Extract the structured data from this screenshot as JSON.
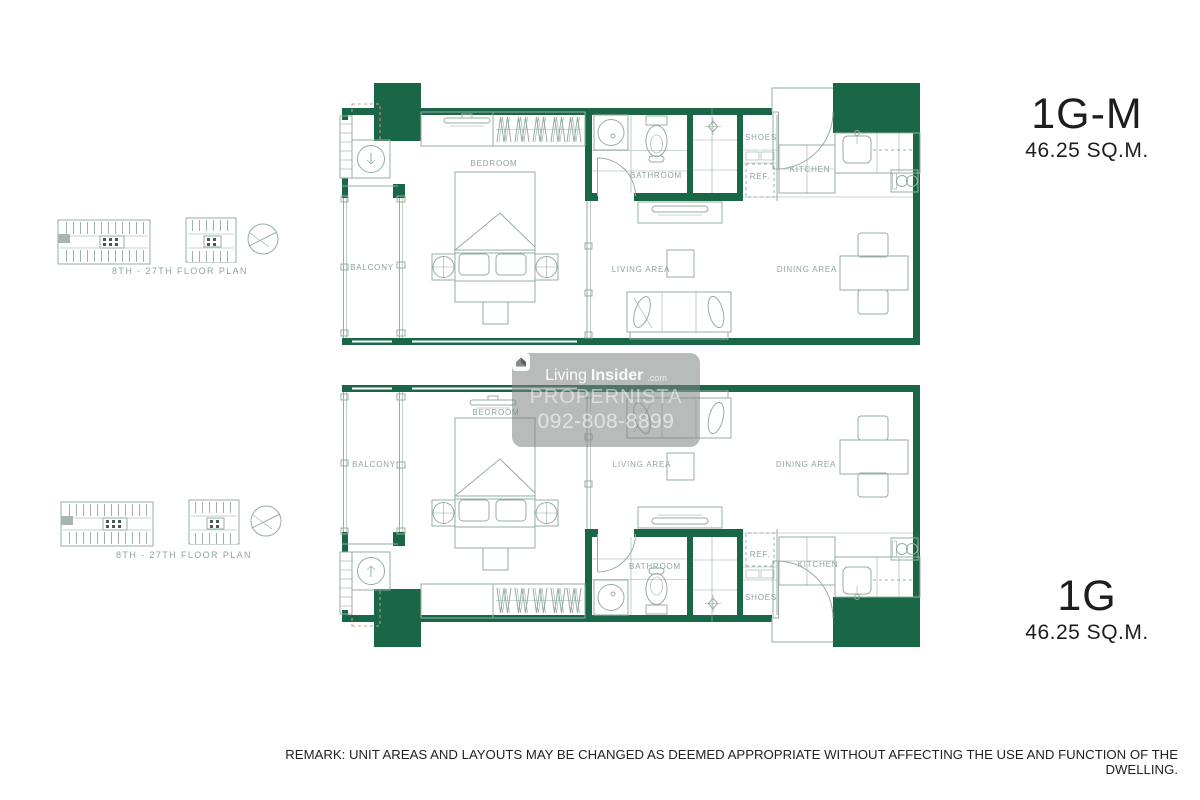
{
  "colors": {
    "wall_green": "#1a6747",
    "plan_line": "#96ada0",
    "label_text": "#8fa698",
    "washer_dash": "#cf9a92",
    "title_text": "#1d1d1d",
    "watermark_bg": "rgba(124,133,132,0.55)"
  },
  "key_plans": [
    {
      "caption": "8TH - 27TH FLOOR PLAN"
    },
    {
      "caption": "8TH - 27TH FLOOR PLAN"
    }
  ],
  "units": [
    {
      "name": "1G-M",
      "area": "46.25 SQ.M.",
      "rooms": {
        "bedroom": "BEDROOM",
        "balcony": "BALCONY",
        "bathroom": "BATHROOM",
        "shoes": "SHOES",
        "ref": "REF.",
        "kitchen": "KITCHEN",
        "living": "LIVING AREA",
        "dining": "DINING AREA"
      }
    },
    {
      "name": "1G",
      "area": "46.25 SQ.M.",
      "rooms": {
        "bedroom": "BEDROOM",
        "balcony": "BALCONY",
        "bathroom": "BATHROOM",
        "shoes": "SHOES",
        "ref": "REF.",
        "kitchen": "KITCHEN",
        "living": "LIVING AREA",
        "dining": "DINING AREA"
      }
    }
  ],
  "watermark": {
    "logo": "living-insider-logo",
    "brand_a": "Living",
    "brand_b": "Insider",
    "brand_suffix": ".com",
    "line2": "PROPERNISTA",
    "line3": "092-808-8899"
  },
  "remark": "REMARK: UNIT AREAS AND LAYOUTS MAY BE CHANGED AS DEEMED APPROPRIATE WITHOUT AFFECTING THE USE AND FUNCTION OF THE DWELLING."
}
